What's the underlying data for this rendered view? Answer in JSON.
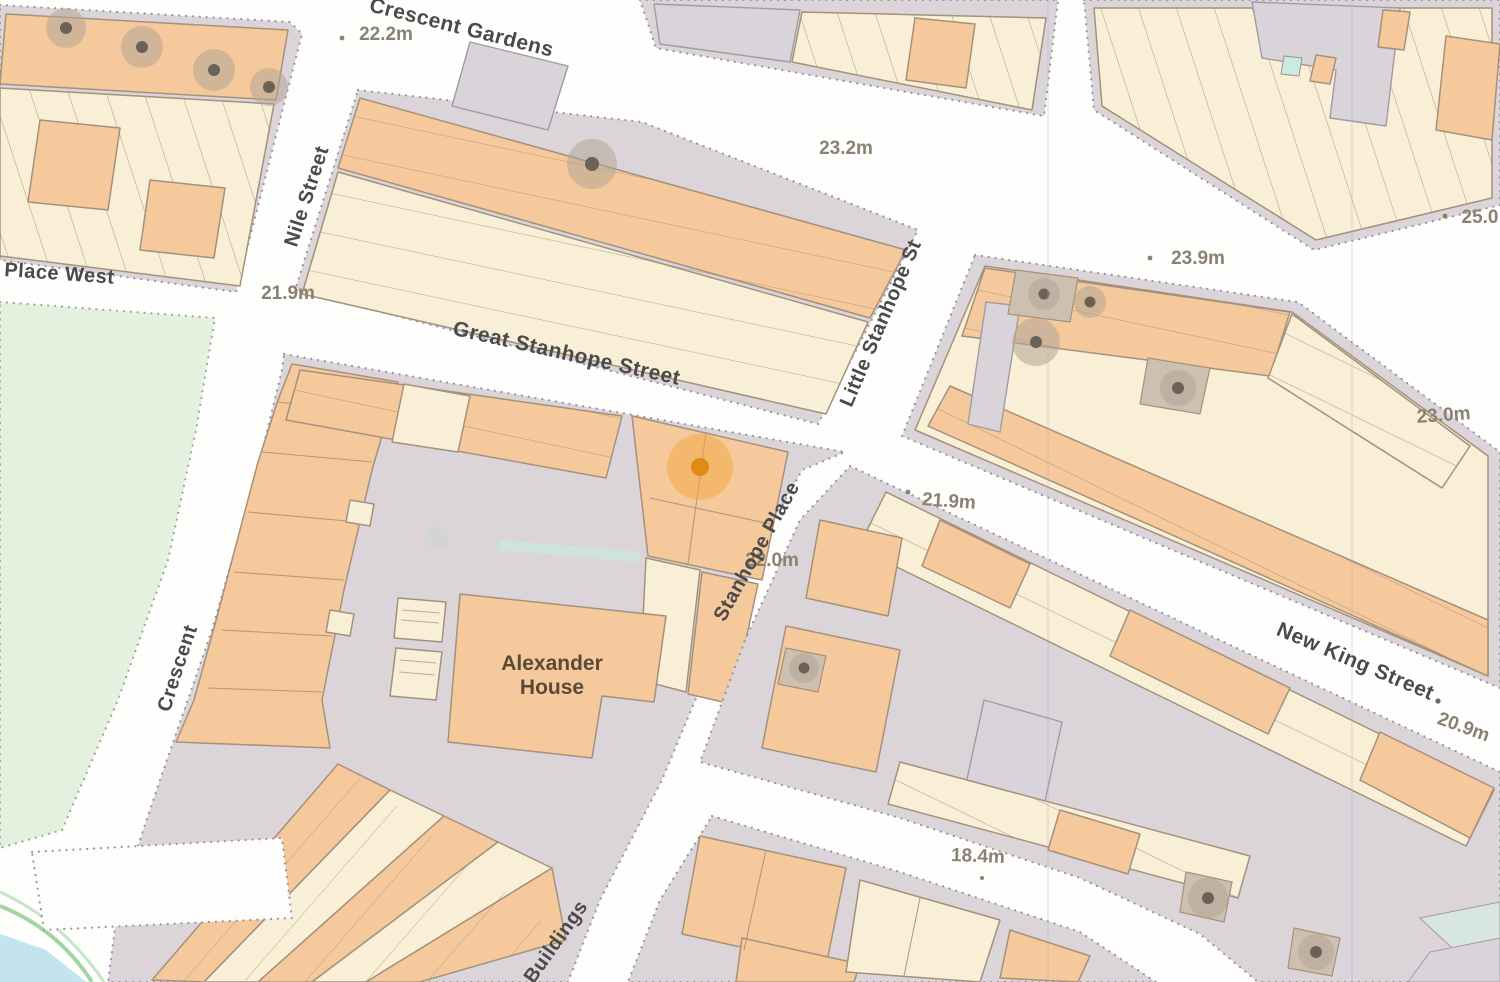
{
  "map": {
    "streets": [
      {
        "name": "Crescent Gardens"
      },
      {
        "name": "Nile Street"
      },
      {
        "name": "Place West"
      },
      {
        "name": "Great Stanhope Street"
      },
      {
        "name": "Little Stanhope St"
      },
      {
        "name": "Stanhope Place"
      },
      {
        "name": "Norfolk  Crescent"
      },
      {
        "name": "New King Street"
      },
      {
        "name": "lk Buildings"
      }
    ],
    "spot_heights": [
      {
        "value": "22.2m"
      },
      {
        "value": "21.9m"
      },
      {
        "value": "23.2m"
      },
      {
        "value": "23.9m"
      },
      {
        "value": "25.0"
      },
      {
        "value": "23.0m"
      },
      {
        "value": "21.9m"
      },
      {
        "value": "22.0m"
      },
      {
        "value": "20.9m"
      },
      {
        "value": "18.4m"
      }
    ],
    "buildings": [
      {
        "label_line1": "Alexander",
        "label_line2": "House"
      }
    ],
    "marker": {
      "description": "orange property location marker"
    },
    "colors": {
      "building_primary": "#F5C99C",
      "building_secondary": "#F9EFD6",
      "building_grey": "#D8D4DA",
      "pavement": "#DBD5DA",
      "road": "#FEFEFD",
      "park_green": "#E4F1DF",
      "water_blue": "#C3E4EF",
      "tree": "#B3A496",
      "marker_halo": "#F4A83B",
      "marker_dot": "#DB8A12",
      "street_text": "#4A4A4A",
      "height_text": "#8B8171"
    }
  }
}
